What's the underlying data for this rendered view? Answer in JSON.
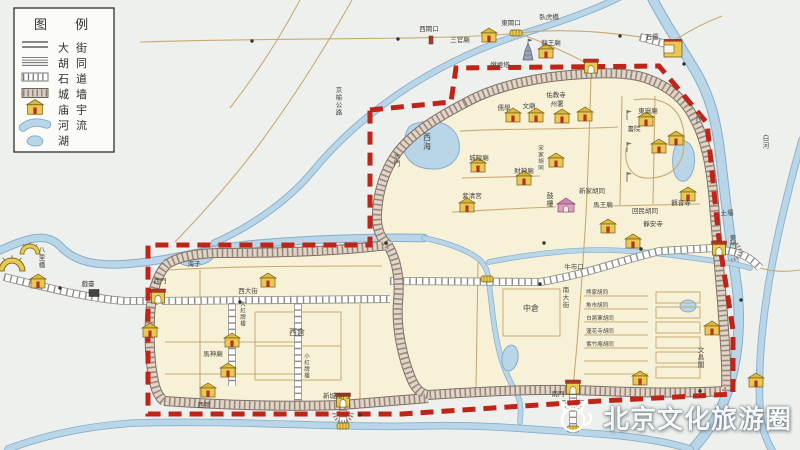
{
  "legend": {
    "title": "图 例",
    "items": [
      {
        "symbol": "street",
        "label": "大街"
      },
      {
        "symbol": "hutong",
        "label": "胡同"
      },
      {
        "symbol": "stone-road",
        "label": "石道"
      },
      {
        "symbol": "wall",
        "label": "城墙"
      },
      {
        "symbol": "temple",
        "label": "庙宇"
      },
      {
        "symbol": "river",
        "label": "河流"
      },
      {
        "symbol": "lake",
        "label": "湖"
      }
    ]
  },
  "watermark": {
    "text": "北京文化旅游圈",
    "logo": "cat-logo"
  },
  "colors": {
    "boundary_red": "#bf2419",
    "river_blue": "#b9d6e8",
    "river_edge": "#86aecb",
    "city_cream": "#f7f1d8",
    "temple_yellow": "#e9c94f",
    "wall_gray": "#d9cec6"
  },
  "map": {
    "labels": [
      {
        "t": "西閘口",
        "x": 429,
        "y": 31
      },
      {
        "t": "東閘口",
        "x": 511,
        "y": 25
      },
      {
        "t": "三官廟",
        "x": 460,
        "y": 42
      },
      {
        "t": "臥虎橋",
        "x": 549,
        "y": 19
      },
      {
        "t": "龍王廟",
        "x": 551,
        "y": 45
      },
      {
        "t": "石壩",
        "x": 652,
        "y": 39
      },
      {
        "t": "土壩",
        "x": 727,
        "y": 215
      },
      {
        "t": "白河",
        "x": 766,
        "y": 140,
        "v": 1
      },
      {
        "t": "京榆公路",
        "x": 339,
        "y": 92,
        "v": 1
      },
      {
        "t": "八里橋",
        "x": 42,
        "y": 252,
        "v": 1
      },
      {
        "t": "戲臺",
        "x": 88,
        "y": 286
      },
      {
        "t": "燃燈塔",
        "x": 500,
        "y": 67
      },
      {
        "t": "佑教寺",
        "x": 556,
        "y": 97
      },
      {
        "t": "儒學",
        "x": 504,
        "y": 110
      },
      {
        "t": "文廟",
        "x": 529,
        "y": 108
      },
      {
        "t": "州署",
        "x": 557,
        "y": 106
      },
      {
        "t": "西海",
        "x": 427,
        "y": 140,
        "v": 1,
        "fs": 8
      },
      {
        "t": "水門",
        "x": 397,
        "y": 158,
        "v": 1
      },
      {
        "t": "紫清宮",
        "x": 472,
        "y": 198
      },
      {
        "t": "城隍廟",
        "x": 479,
        "y": 160
      },
      {
        "t": "財神廟",
        "x": 524,
        "y": 173
      },
      {
        "t": "宋家胡同",
        "x": 541,
        "y": 150,
        "v": 1,
        "fs": 5.5
      },
      {
        "t": "東嶽廟",
        "x": 648,
        "y": 113
      },
      {
        "t": "書院",
        "x": 634,
        "y": 131
      },
      {
        "t": "鼓樓",
        "x": 550,
        "y": 198,
        "v": 1,
        "fs": 7
      },
      {
        "t": "馬王廟",
        "x": 603,
        "y": 207
      },
      {
        "t": "新家胡同",
        "x": 592,
        "y": 193
      },
      {
        "t": "回民胡同",
        "x": 645,
        "y": 213
      },
      {
        "t": "觀音寺",
        "x": 681,
        "y": 205
      },
      {
        "t": "靜安寺",
        "x": 653,
        "y": 226
      },
      {
        "t": "牛市口",
        "x": 574,
        "y": 269
      },
      {
        "t": "中倉",
        "x": 531,
        "y": 311,
        "fs": 8
      },
      {
        "t": "西倉",
        "x": 297,
        "y": 335,
        "fs": 8
      },
      {
        "t": "南大街",
        "x": 566,
        "y": 292,
        "v": 1
      },
      {
        "t": "熊家胡同",
        "x": 597,
        "y": 294,
        "fs": 5.5
      },
      {
        "t": "魚市胡同",
        "x": 597,
        "y": 307,
        "fs": 5.5
      },
      {
        "t": "白將軍胡同",
        "x": 600,
        "y": 320,
        "fs": 5.5
      },
      {
        "t": "蓮花寺胡同",
        "x": 600,
        "y": 333,
        "fs": 5.5
      },
      {
        "t": "紫竹庵胡同",
        "x": 600,
        "y": 346,
        "fs": 5.5
      },
      {
        "t": "文昌閣",
        "x": 701,
        "y": 352,
        "v": 1
      },
      {
        "t": "東門",
        "x": 733,
        "y": 240,
        "v": 1
      },
      {
        "t": "海子",
        "x": 194,
        "y": 266
      },
      {
        "t": "西大街",
        "x": 248,
        "y": 293
      },
      {
        "t": "大紅牌樓",
        "x": 243,
        "y": 306,
        "v": 1,
        "fs": 5.5
      },
      {
        "t": "小紅牌樓",
        "x": 307,
        "y": 358,
        "v": 1,
        "fs": 5.5
      },
      {
        "t": "西門",
        "x": 160,
        "y": 283
      },
      {
        "t": "馬神廟",
        "x": 213,
        "y": 356
      },
      {
        "t": "西營",
        "x": 204,
        "y": 407
      },
      {
        "t": "新城南門",
        "x": 336,
        "y": 398
      },
      {
        "t": "南門",
        "x": 558,
        "y": 396
      }
    ],
    "icons": [
      {
        "k": "temple",
        "x": 489,
        "y": 37
      },
      {
        "k": "temple",
        "x": 546,
        "y": 53
      },
      {
        "k": "temple",
        "x": 513,
        "y": 117
      },
      {
        "k": "temple",
        "x": 536,
        "y": 117
      },
      {
        "k": "temple",
        "x": 562,
        "y": 118
      },
      {
        "k": "temple",
        "x": 585,
        "y": 116
      },
      {
        "k": "temple",
        "x": 478,
        "y": 167
      },
      {
        "k": "temple",
        "x": 467,
        "y": 207
      },
      {
        "k": "temple",
        "x": 524,
        "y": 180
      },
      {
        "k": "temple",
        "x": 556,
        "y": 162
      },
      {
        "k": "temple",
        "x": 646,
        "y": 121
      },
      {
        "k": "temple",
        "x": 659,
        "y": 148
      },
      {
        "k": "temple",
        "x": 676,
        "y": 140
      },
      {
        "k": "temple",
        "x": 608,
        "y": 228
      },
      {
        "k": "temple",
        "x": 633,
        "y": 243
      },
      {
        "k": "temple",
        "x": 688,
        "y": 196
      },
      {
        "k": "temple",
        "x": 712,
        "y": 330
      },
      {
        "k": "temple",
        "x": 640,
        "y": 380
      },
      {
        "k": "temple",
        "x": 268,
        "y": 282
      },
      {
        "k": "temple",
        "x": 232,
        "y": 342
      },
      {
        "k": "temple",
        "x": 228,
        "y": 372
      },
      {
        "k": "temple",
        "x": 150,
        "y": 332
      },
      {
        "k": "temple",
        "x": 208,
        "y": 392
      },
      {
        "k": "temple",
        "x": 38,
        "y": 283
      },
      {
        "k": "temple",
        "x": 756,
        "y": 382
      },
      {
        "k": "flag",
        "x": 627,
        "y": 116
      },
      {
        "k": "flag",
        "x": 627,
        "y": 148
      },
      {
        "k": "flag",
        "x": 627,
        "y": 178
      },
      {
        "k": "flag",
        "x": 697,
        "y": 120
      },
      {
        "k": "gate",
        "x": 591,
        "y": 67
      },
      {
        "k": "gate",
        "x": 719,
        "y": 249
      },
      {
        "k": "gate",
        "x": 158,
        "y": 297
      },
      {
        "k": "gate",
        "x": 343,
        "y": 401
      },
      {
        "k": "gate",
        "x": 573,
        "y": 388
      },
      {
        "k": "barbican",
        "x": 343,
        "y": 413
      },
      {
        "k": "barbican",
        "x": 573,
        "y": 400
      },
      {
        "k": "barbican",
        "x": 731,
        "y": 251,
        "r": -90
      },
      {
        "k": "bridge",
        "x": 516,
        "y": 33
      },
      {
        "k": "bridge",
        "x": 487,
        "y": 279
      },
      {
        "k": "bridge",
        "x": 343,
        "y": 426
      },
      {
        "k": "bridge",
        "x": 573,
        "y": 429
      },
      {
        "k": "fanbridge",
        "x": 30,
        "y": 251
      },
      {
        "k": "fanbridge",
        "x": 12,
        "y": 267,
        "s": 1.3
      },
      {
        "k": "pagoda",
        "x": 528,
        "y": 55
      },
      {
        "k": "drumtower",
        "x": 566,
        "y": 207
      },
      {
        "k": "ubuilding",
        "x": 673,
        "y": 49
      },
      {
        "k": "stage",
        "x": 94,
        "y": 293
      },
      {
        "k": "sluice",
        "x": 431,
        "y": 40
      },
      {
        "k": "figure",
        "x": 252,
        "y": 41
      },
      {
        "k": "figure",
        "x": 398,
        "y": 39
      },
      {
        "k": "figure",
        "x": 620,
        "y": 36
      },
      {
        "k": "figure",
        "x": 386,
        "y": 243
      },
      {
        "k": "figure",
        "x": 544,
        "y": 243
      },
      {
        "k": "figure",
        "x": 641,
        "y": 249
      },
      {
        "k": "figure",
        "x": 240,
        "y": 302
      },
      {
        "k": "figure",
        "x": 540,
        "y": 284
      },
      {
        "k": "figure",
        "x": 741,
        "y": 300
      },
      {
        "k": "figure",
        "x": 700,
        "y": 391
      },
      {
        "k": "figure",
        "x": 360,
        "y": 415
      },
      {
        "k": "figure",
        "x": 60,
        "y": 288
      },
      {
        "k": "figure",
        "x": 684,
        "y": 64
      }
    ]
  }
}
